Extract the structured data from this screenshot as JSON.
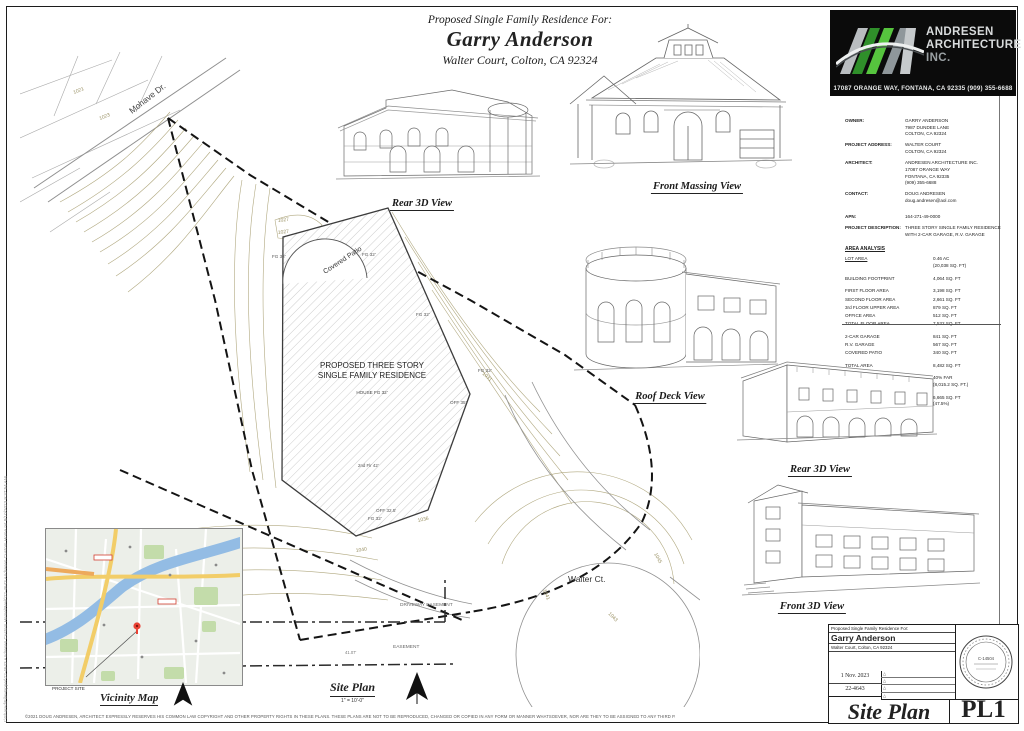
{
  "header": {
    "line1": "Proposed Single Family Residence For:",
    "owner_name": "Garry Anderson",
    "address": "Walter Court, Colton, CA 92324"
  },
  "logo": {
    "name_line1": "ANDRESEN",
    "name_line2": "ARCHITECTURE",
    "name_line3": "INC.",
    "address": "17087 ORANGE WAY, FONTANA, CA 92335 (909) 355-6688"
  },
  "info": {
    "fields": [
      {
        "label": "OWNER:",
        "lines": [
          "GARRY ANDERSON",
          "7987 DUNDEE LANE",
          "COLTON, CA 92324"
        ]
      },
      {
        "label": "PROJECT ADDRESS:",
        "lines": [
          "WALTER COURT",
          "COLTON, CA 92324"
        ]
      },
      {
        "label": "ARCHITECT:",
        "lines": [
          "ANDRESEN ARCHITECTURE INC.",
          "17087 ORANGE WAY",
          "FONTANA, CA  92335",
          "(909) 355-6688"
        ]
      },
      {
        "label": "CONTACT:",
        "lines": [
          "DOUG ANDRESEN",
          "doug.andresen@aol.com"
        ]
      },
      {
        "label": "APN:",
        "lines": [
          "164-271-49-0000"
        ]
      },
      {
        "label": "PROJECT DESCRIPTION:",
        "lines": [
          "THREE STORY SINGLE FAMILY RESIDENCE",
          "WITH 2-CAR GARAGE, R.V. GARAGE"
        ]
      }
    ],
    "area_title": "AREA ANALYSIS",
    "area_rows": [
      {
        "label": "LOT AREA",
        "value": "0.46 AC\n(20,038 SQ. FT)"
      },
      {
        "label": "BUILDING FOOTPRINT",
        "value": "4,064 SQ. FT"
      },
      {
        "label": "FIRST FLOOR AREA",
        "value": "3,198 SQ. FT"
      },
      {
        "label": "SECOND FLOOR AREA",
        "value": "2,661 SQ. FT"
      },
      {
        "label": "3rd FLOOR UPPER AREA",
        "value": "879 SQ. FT"
      },
      {
        "label": "OFFICE AREA",
        "value": "512 SQ. FT"
      },
      {
        "label": "TOTAL FLOOR AREA",
        "value": "7,532 SQ. FT"
      },
      {
        "label": "2-CAR GARAGE",
        "value": "841 SQ. FT"
      },
      {
        "label": "R.V. GARAGE",
        "value": "567 SQ. FT"
      },
      {
        "label": "COVERED PATIO",
        "value": "340 SQ. FT"
      },
      {
        "label": "TOTAL AREA",
        "value": "8,482 SQ. FT"
      },
      {
        "label": "FAR MAXIMUM",
        "value": "40% FAR\n(8,015.2 SQ. FT.)"
      },
      {
        "label": "FAR",
        "value": "6,665 SQ. FT\n(47.5%)"
      }
    ]
  },
  "views": [
    {
      "label": "Rear 3D View"
    },
    {
      "label": "Front Massing View"
    },
    {
      "label": "Roof Deck View"
    },
    {
      "label": "Rear 3D View"
    },
    {
      "label": "Front 3D View"
    }
  ],
  "site": {
    "proposed_line1": "PROPOSED THREE STORY",
    "proposed_line2": "SINGLE FAMILY RESIDENCE",
    "house_fg": "HOUSE FG 32'",
    "covered_patio": "Covered Patio",
    "fg_label": "FG 32'",
    "off1": "OFF 35'",
    "off2": "OFF 32.5'",
    "second_flr": "2nd Flr 42'",
    "walter": "Walter Ct.",
    "mohave": "Mohave Dr.",
    "driveway_easement": "DRIVEWAY EASEMENT",
    "easement": "EASEMENT",
    "dim": "41.07'",
    "plan_title": "Site Plan",
    "plan_scale": "1\" = 10'-0\"",
    "contour_labels": [
      "1021",
      "1023",
      "1027",
      "1027",
      "1031",
      "1036",
      "1040",
      "1041",
      "1043",
      "1045"
    ]
  },
  "vicinity": {
    "title": "Vicinity Map",
    "site_label": "PROJECT SITE"
  },
  "titleblock": {
    "project_line": "Proposed Single Family Residence For:",
    "owner": "Garry Anderson",
    "address": "Walter Court, Colton, CA 92324",
    "date": "1 Nov. 2023",
    "job_number": "22-4643",
    "sheet_title": "Site Plan",
    "sheet_number": "PL1",
    "stamp_number": "C-14504",
    "delta": "△"
  },
  "footer": {
    "copyright": "©2021 DOUG ANDRESEN, ARCHITECT EXPRESSLY RESERVES HIS COMMON LAW COPYRIGHT AND OTHER PROPERTY RIGHTS IN THESE PLANS. THESE PLANS ARE NOT TO BE REPRODUCED, CHANGED OR COPIED IN ANY FORM OR MANNER WHATSOEVER, NOR ARE THEY TO BE ASSIGNED TO ANY THIRD PARTY WITHOUT FIRST OBTAINING THE EXPRESS WRITTEN PERMISSION AND CONSENT OF DOUGLAS ANDRESEN, ARCHITECT."
  },
  "edge": {
    "file_info": "I:\\Shared\\FileHopper\\22-4643 Andresen Custom Home\\Revit\\22-4643 Andresen Custom Home.rvt     8/10/2023 9:37:54 AM"
  }
}
